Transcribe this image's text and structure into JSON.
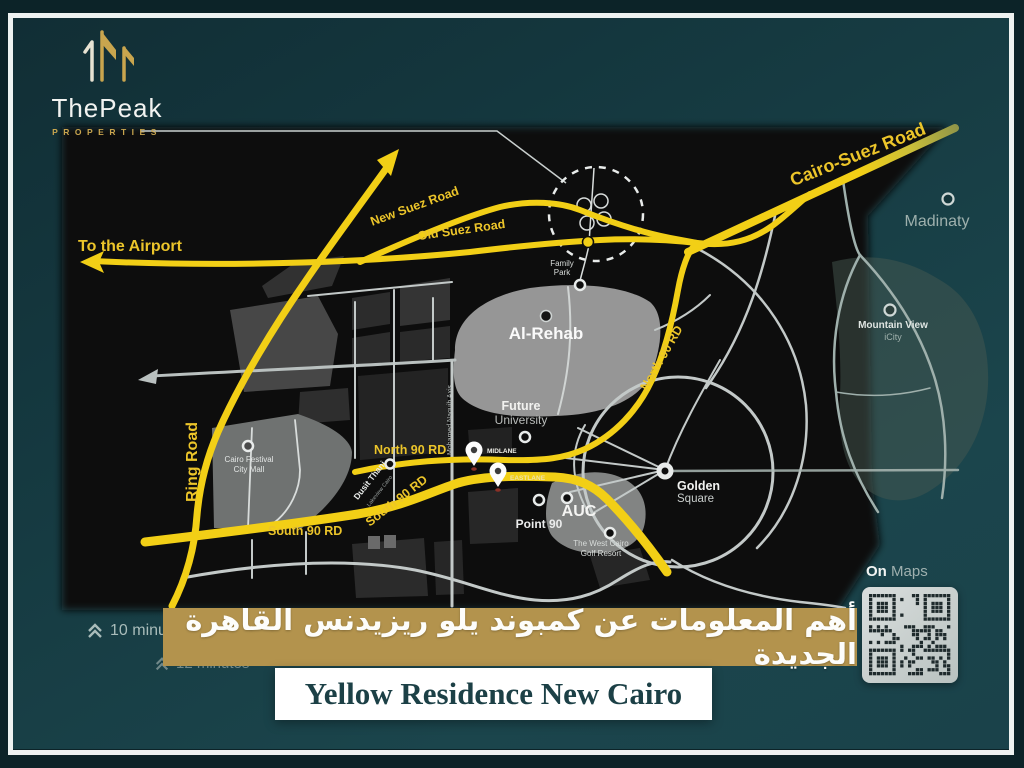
{
  "brand": {
    "name": "ThePeak",
    "tagline": "PROPERTIES"
  },
  "banners": {
    "arabic_title": "أهم المعلومات عن كمبوند يلو ريزيدنس القاهرة الجديدة",
    "english_title": "Yellow Residence New Cairo"
  },
  "overlay": {
    "time_1": "10 minutes",
    "time_2": "12 minutes",
    "on_maps_bold": "On",
    "on_maps_rest": " Maps"
  },
  "map": {
    "labels": {
      "to_airport": "To the Airport",
      "new_suez": "New Suez Road",
      "old_suez": "Old Suez Road",
      "cairo_suez": "Cairo-Suez Road",
      "ring_road": "Ring Road",
      "north_90_h": "North 90 RD",
      "north_90_d": "North 90 RD",
      "south_90_h": "South 90 RD",
      "south_90_d": "South 90 RD",
      "al_rehab": "Al-Rehab",
      "madinaty": "Madinaty",
      "mountain_view": "Mountain View",
      "icity": "iCity",
      "family_1": "Family",
      "family_2": "Park",
      "future_1": "Future",
      "future_2": "University",
      "cfcm_1": "Cairo Festival",
      "cfcm_2": "City Mall",
      "dusit": "Dusit Thani",
      "dusit_sub": "Lakeview Cairo",
      "auc": "AUC",
      "point_90": "Point 90",
      "golf_1": "The West Cairo",
      "golf_2": "Golf Resort",
      "golden_1": "Golden",
      "golden_2": "Square",
      "naguib": "Mohamed Naguib Axis",
      "pin_midlane": "MIDLANE",
      "pin_eastlane": "EASTLANE"
    }
  },
  "colors": {
    "road_yellow": "#f2cf16",
    "banner_gold": "#b3934d",
    "frame_white": "#eef2f1",
    "teal_bg": "#163a41",
    "logo_gold": "#c9a54e"
  }
}
